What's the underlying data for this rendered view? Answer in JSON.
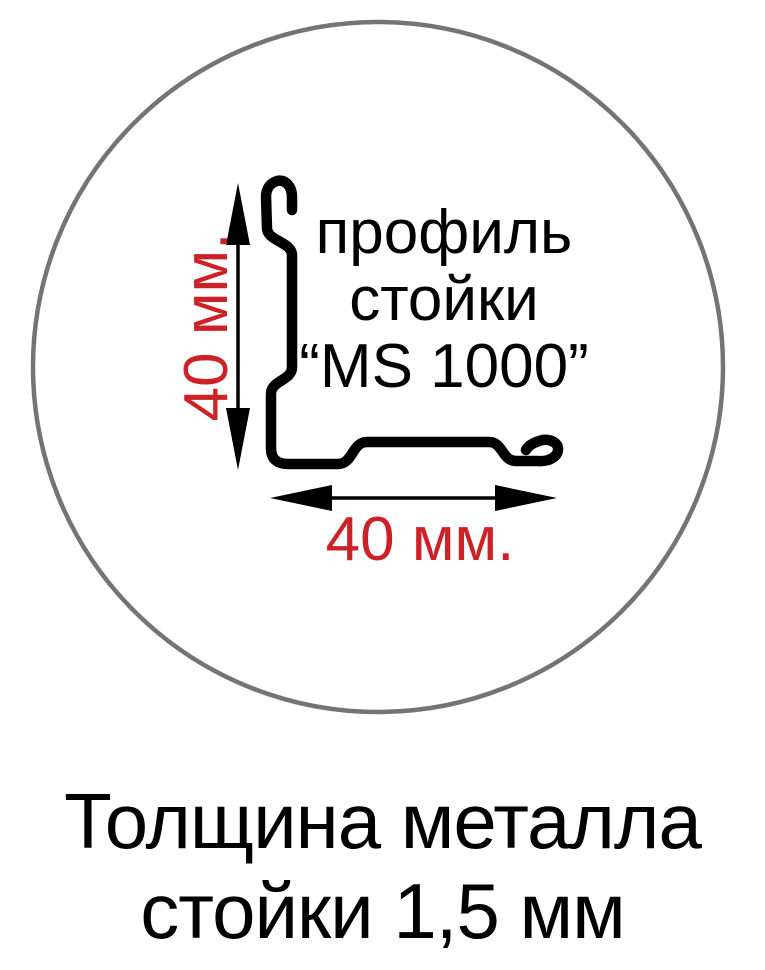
{
  "colors": {
    "background": "#ffffff",
    "line_black": "#000000",
    "circle_gray": "#737477",
    "accent_red": "#cc2127"
  },
  "diagram": {
    "label_line1": "профиль",
    "label_line2": "стойки",
    "label_line3": "“MS 1000”",
    "height_dimension": "40 мм.",
    "width_dimension": "40 мм."
  },
  "caption": {
    "line1": "Толщина металла",
    "line2": "стойки 1,5 мм"
  }
}
